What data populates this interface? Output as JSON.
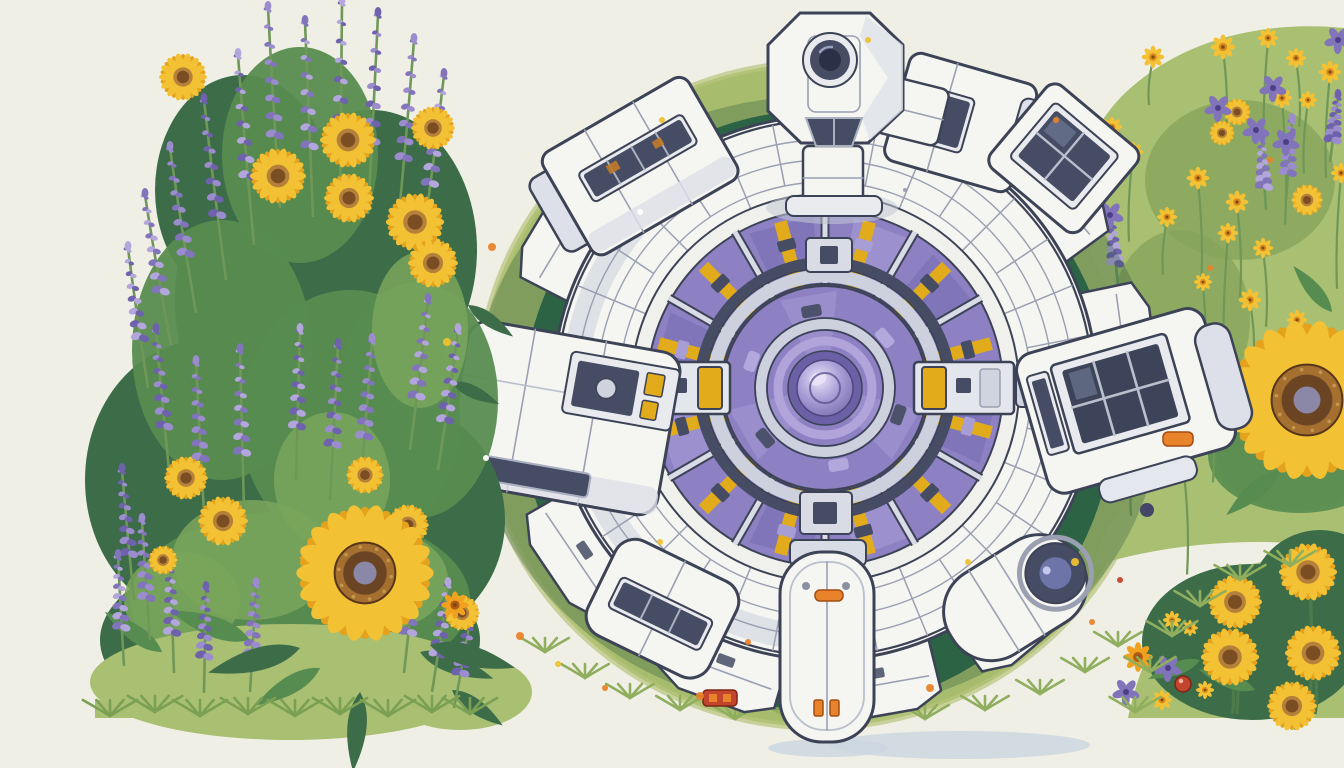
{
  "scene": {
    "title": "Top-down illustration of a white modular space station with a purple glass core, sitting on a round green meadow surrounded by sunflowers and lavender",
    "palette": {
      "background": "#f0efe5",
      "meadow_light": "#a7bd6d",
      "meadow_dark": "#2e6b4a",
      "meadow_olive": "#b6c47c",
      "hull": "#f5f5f1",
      "hull_shade": "#dde0e8",
      "ink": "#3d4356",
      "line": "#9aa0b2",
      "silver": "#ccd1dd",
      "slate": "#454c64",
      "glass": "#8d81c4",
      "glass_light": "#aba0d8",
      "glass_dark": "#6b5fa6",
      "orb_hi": "#e9e3f7",
      "yellow": "#e2ab1c",
      "orange": "#e8832b",
      "red": "#c2452e",
      "gold": "#f0c030",
      "navy": "#3d3f66",
      "leaf_dark": "#3c6c48",
      "leaf_mid": "#578c50",
      "leaf_light": "#7aa65c",
      "grass_light": "#a9bf72",
      "stem": "#6f9858",
      "lavender": [
        "#9b8ccd",
        "#8174bb",
        "#b3a6dc",
        "#6f62ad"
      ],
      "petal": "#f3c134",
      "petal_dark": "#e5a31d",
      "disc_ring": "#a56f30",
      "disc": "#6b4423",
      "disc_core": "#8b87a6",
      "daisy_center": "#d98a1f",
      "shadow": "#ccd6e2",
      "white": "#ffffff"
    },
    "meadow": {
      "cx": 818,
      "cy": 395,
      "rx": 340,
      "ry": 332,
      "dark_cx": 818,
      "dark_cy": 410,
      "dark_rx": 296,
      "dark_ry": 300,
      "shadows": [
        [
          960,
          745,
          130,
          14
        ],
        [
          828,
          748,
          60,
          9
        ]
      ],
      "edge_tufts": [
        [
          545,
          652
        ],
        [
          585,
          678
        ],
        [
          630,
          698
        ],
        [
          680,
          710
        ],
        [
          735,
          719
        ],
        [
          795,
          722
        ],
        [
          860,
          722
        ],
        [
          925,
          719
        ],
        [
          985,
          710
        ],
        [
          1040,
          694
        ],
        [
          1085,
          672
        ],
        [
          1118,
          646
        ]
      ]
    },
    "station": {
      "cx": 825,
      "cy": 388,
      "hull_r": 272,
      "wedge_angles": [
        50,
        80,
        110,
        146,
        178,
        211,
        320,
        352
      ],
      "wedge_r1": 235,
      "wedge_r2": 334,
      "seam_count": 32,
      "ring_radii": [
        268,
        248,
        228,
        206
      ],
      "purple_r": 178,
      "spoke_count": 12,
      "spoke_inner": 58,
      "spoke_outer": 172,
      "core": {
        "slate_r": 126,
        "silver_r": 112,
        "dome_r": 102,
        "ring2_r": 64,
        "ring3_r": 47,
        "disc_r": 37,
        "orb_r": 28
      },
      "turret": {
        "octagon": "800,13 870,13 903,45 903,110 868,143 801,143 768,111 768,45",
        "lens_cx": 830,
        "lens_cy": 60
      },
      "connectors": {
        "w": {
          "x": 630,
          "y": 362
        },
        "e": {
          "x": 914,
          "y": 362
        }
      },
      "accent_lights": [
        [
          815,
          590,
          28,
          11
        ],
        [
          1163,
          432,
          30,
          14
        ]
      ],
      "red_light": [
        703,
        690,
        34,
        16
      ],
      "flecks": [
        [
          700,
          320
        ],
        [
          760,
          480
        ],
        [
          900,
          300
        ],
        [
          950,
          470
        ],
        [
          870,
          252
        ],
        [
          706,
          430
        ],
        [
          905,
          190
        ],
        [
          760,
          250
        ]
      ]
    },
    "left_cluster": {
      "foliage_dark": [
        [
          290,
          640,
          190,
          95
        ],
        [
          205,
          480,
          120,
          140
        ],
        [
          390,
          520,
          115,
          120
        ],
        [
          300,
          300,
          125,
          165
        ],
        [
          243,
          190,
          88,
          115
        ],
        [
          372,
          250,
          105,
          140
        ]
      ],
      "foliage_mid": [
        [
          300,
          600,
          170,
          90
        ],
        [
          350,
          420,
          110,
          130
        ],
        [
          222,
          350,
          90,
          130
        ],
        [
          418,
          400,
          80,
          118
        ],
        [
          300,
          155,
          78,
          108
        ]
      ],
      "foliage_light": [
        [
          252,
          560,
          80,
          60
        ],
        [
          380,
          580,
          68,
          50
        ],
        [
          182,
          600,
          58,
          48
        ],
        [
          332,
          480,
          58,
          68
        ],
        [
          420,
          330,
          48,
          78
        ]
      ],
      "mound": [
        [
          290,
          682,
          200,
          58
        ],
        [
          460,
          692,
          72,
          38
        ]
      ],
      "lavender": [
        [
          268,
          8,
          200,
          -12
        ],
        [
          305,
          22,
          195,
          -8
        ],
        [
          342,
          2,
          215,
          2
        ],
        [
          378,
          14,
          200,
          10
        ],
        [
          414,
          40,
          185,
          16
        ],
        [
          444,
          75,
          170,
          22
        ],
        [
          238,
          55,
          190,
          -16
        ],
        [
          204,
          100,
          180,
          -22
        ],
        [
          170,
          148,
          165,
          -26
        ],
        [
          145,
          195,
          150,
          -26
        ],
        [
          128,
          248,
          140,
          -20
        ],
        [
          156,
          330,
          150,
          -14
        ],
        [
          196,
          362,
          150,
          -8
        ],
        [
          240,
          350,
          160,
          -4
        ],
        [
          300,
          330,
          150,
          4
        ],
        [
          338,
          345,
          155,
          8
        ],
        [
          372,
          340,
          150,
          12
        ],
        [
          428,
          300,
          150,
          18
        ],
        [
          458,
          330,
          140,
          20
        ],
        [
          122,
          470,
          130,
          -12
        ],
        [
          142,
          520,
          120,
          -8
        ],
        [
          118,
          556,
          110,
          -6
        ],
        [
          170,
          558,
          115,
          -4
        ],
        [
          206,
          588,
          105,
          2
        ],
        [
          256,
          584,
          108,
          6
        ],
        [
          416,
          558,
          115,
          12
        ],
        [
          448,
          584,
          108,
          16
        ],
        [
          472,
          608,
          100,
          18
        ]
      ],
      "sunflowers": [
        [
          183,
          77,
          23
        ],
        [
          348,
          140,
          27
        ],
        [
          278,
          176,
          27
        ],
        [
          349,
          198,
          24
        ],
        [
          415,
          222,
          28
        ],
        [
          433,
          263,
          24
        ],
        [
          433,
          128,
          21
        ],
        [
          365,
          475,
          18
        ],
        [
          408,
          525,
          20
        ],
        [
          223,
          521,
          24
        ],
        [
          186,
          478,
          21
        ],
        [
          163,
          560,
          14
        ],
        [
          402,
          585,
          15
        ],
        [
          462,
          613,
          17
        ]
      ],
      "orange_daisies": [
        [
          455,
          605,
          12
        ],
        [
          310,
          558,
          9
        ]
      ],
      "big_sunflower": [
        365,
        573,
        66
      ],
      "leaves": [
        [
          250,
          640,
          85,
          200
        ],
        [
          320,
          668,
          75,
          150
        ],
        [
          420,
          652,
          78,
          20
        ],
        [
          452,
          690,
          62,
          35
        ],
        [
          162,
          652,
          70,
          215
        ],
        [
          360,
          692,
          80,
          95
        ],
        [
          468,
          305,
          55,
          35
        ],
        [
          452,
          382,
          52,
          25
        ]
      ],
      "base_tufts": [
        [
          110,
          716
        ],
        [
          155,
          712
        ],
        [
          200,
          716
        ],
        [
          248,
          714
        ],
        [
          295,
          716
        ],
        [
          340,
          714
        ],
        [
          388,
          716
        ],
        [
          432,
          712
        ],
        [
          470,
          714
        ]
      ]
    },
    "right_hill": {
      "outline": "M1344,28 C1262,20 1180,40 1124,94 C1080,138 1066,196 1090,252 C1111,300 1151,330 1160,374 C1170,418 1154,462 1128,497 C1111,520 1098,542 1094,566 C1170,542 1260,536 1344,548 Z",
      "patches": [
        [
          1240,
          180,
          95,
          80
        ],
        [
          1180,
          320,
          70,
          90
        ],
        [
          1295,
          445,
          80,
          66
        ]
      ],
      "daisies": [
        [
          1153,
          57,
          10
        ],
        [
          1223,
          47,
          11
        ],
        [
          1268,
          38,
          9
        ],
        [
          1296,
          58,
          9
        ],
        [
          1330,
          72,
          10
        ],
        [
          1112,
          127,
          9
        ],
        [
          1133,
          152,
          9
        ],
        [
          1282,
          98,
          9
        ],
        [
          1308,
          100,
          8
        ],
        [
          1198,
          178,
          10
        ],
        [
          1167,
          217,
          9
        ],
        [
          1237,
          202,
          10
        ],
        [
          1228,
          233,
          9
        ],
        [
          1263,
          248,
          9
        ],
        [
          1341,
          173,
          9
        ],
        [
          1250,
          300,
          10
        ],
        [
          1297,
          320,
          9
        ],
        [
          1203,
          282,
          8
        ],
        [
          1148,
          388,
          9
        ],
        [
          1210,
          362,
          8
        ],
        [
          1135,
          448,
          9
        ],
        [
          1184,
          470,
          8
        ]
      ],
      "mini_sunflowers": [
        [
          1237,
          112,
          13
        ],
        [
          1307,
          200,
          15
        ],
        [
          1222,
          133,
          12
        ]
      ],
      "purple_flowers": [
        [
          1218,
          108
        ],
        [
          1256,
          130
        ],
        [
          1286,
          142
        ],
        [
          1273,
          88
        ],
        [
          1338,
          40
        ],
        [
          1110,
          215
        ]
      ],
      "lavender": [
        [
          1292,
          120,
          80,
          6
        ],
        [
          1262,
          140,
          70,
          -4
        ],
        [
          1112,
          218,
          68,
          -6
        ],
        [
          1338,
          96,
          66,
          8
        ]
      ],
      "big_sunflower": [
        1307,
        400,
        77
      ],
      "leaves": [
        [
          1280,
          470,
          70,
          140
        ],
        [
          1332,
          312,
          60,
          230
        ],
        [
          1255,
          432,
          55,
          30
        ]
      ]
    },
    "lower_right": {
      "grass": "M1128,718 C1136,680 1150,640 1178,608 C1206,576 1250,560 1300,556 C1316,554 1332,556 1344,558 L1344,718 Z",
      "dark_blobs": [
        [
          1252,
          642,
          110,
          78
        ],
        [
          1320,
          600,
          70,
          70
        ]
      ],
      "sunflowers": [
        [
          1235,
          602,
          26
        ],
        [
          1308,
          572,
          28
        ],
        [
          1230,
          657,
          28
        ],
        [
          1313,
          653,
          27
        ],
        [
          1292,
          706,
          24
        ]
      ],
      "small_daisies": [
        [
          1172,
          620,
          8
        ],
        [
          1190,
          628,
          7
        ],
        [
          1162,
          700,
          9
        ],
        [
          1205,
          690,
          8
        ]
      ],
      "orange_daisies": [
        [
          1138,
          657,
          13
        ]
      ],
      "berry": [
        1183,
        684,
        8
      ],
      "purple_small": [
        [
          1168,
          668
        ],
        [
          1126,
          692
        ]
      ],
      "tufts": [
        [
          1135,
          712
        ],
        [
          1150,
          672
        ],
        [
          1172,
          636
        ],
        [
          1200,
          606
        ],
        [
          1240,
          580
        ],
        [
          1290,
          566
        ]
      ]
    },
    "scatter_dots": [
      [
        492,
        247,
        4,
        "orange"
      ],
      [
        520,
        636,
        4,
        "orange"
      ],
      [
        558,
        664,
        3,
        "gold"
      ],
      [
        605,
        688,
        3,
        "orange"
      ],
      [
        662,
        120,
        3,
        "gold"
      ],
      [
        700,
        696,
        4,
        "orange"
      ],
      [
        748,
        642,
        3,
        "orange"
      ],
      [
        930,
        688,
        4,
        "orange"
      ],
      [
        968,
        562,
        3,
        "gold"
      ],
      [
        1075,
        562,
        4,
        "gold"
      ],
      [
        1092,
        622,
        3,
        "orange"
      ],
      [
        1246,
        302,
        3,
        "gold"
      ],
      [
        1210,
        268,
        3,
        "orange"
      ],
      [
        660,
        542,
        3,
        "gold"
      ],
      [
        486,
        458,
        3,
        "white"
      ],
      [
        1270,
        160,
        3,
        "orange"
      ],
      [
        868,
        40,
        3,
        "gold"
      ],
      [
        640,
        212,
        3,
        "white"
      ],
      [
        1056,
        120,
        3,
        "orange"
      ],
      [
        1120,
        580,
        3,
        "red"
      ],
      [
        1147,
        510,
        7,
        "navy"
      ],
      [
        447,
        342,
        4,
        "gold"
      ]
    ]
  }
}
